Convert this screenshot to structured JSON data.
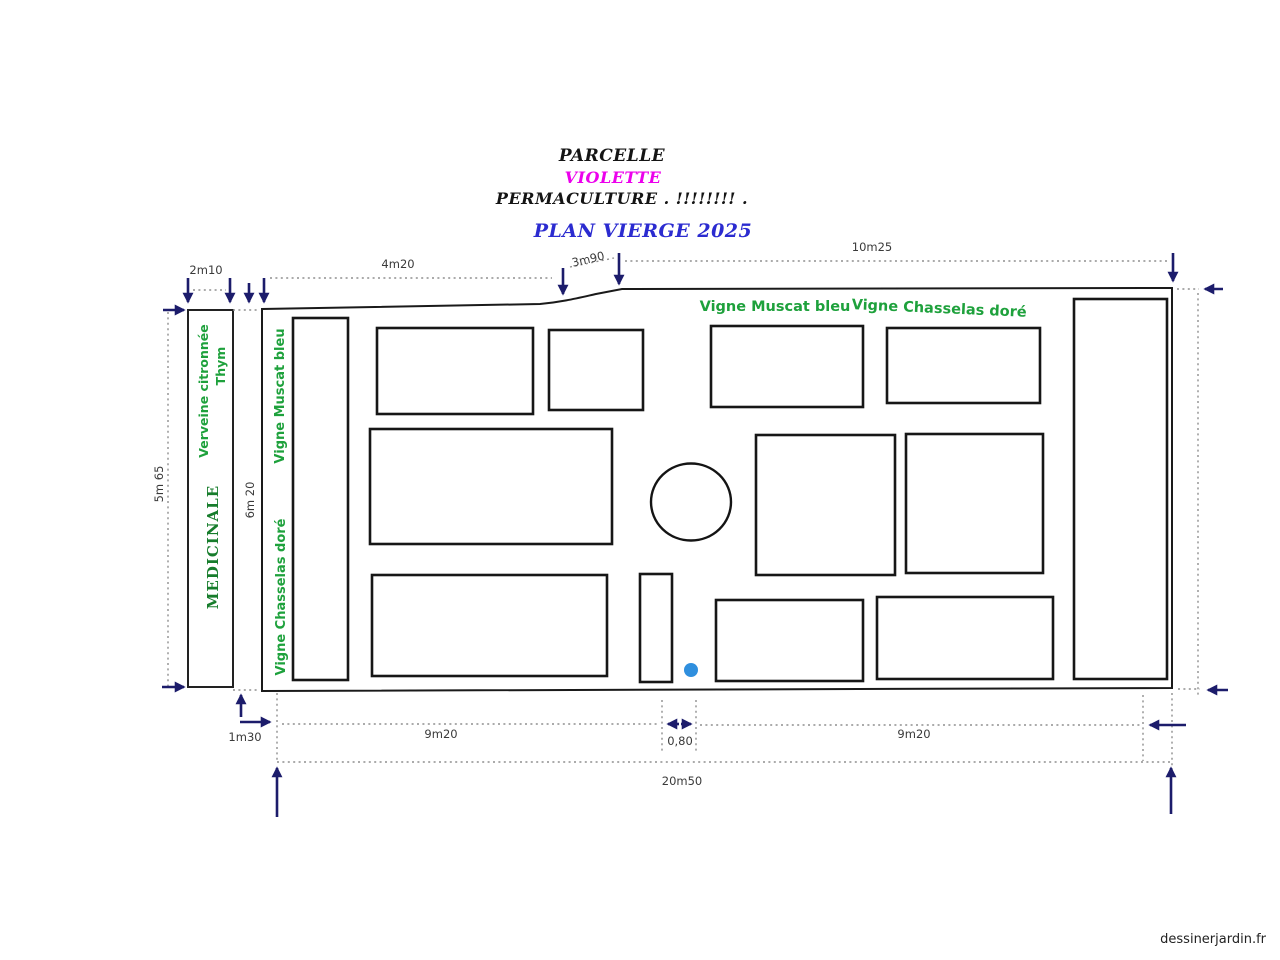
{
  "title": {
    "parcelle": "PARCELLE",
    "violette": "VIOLETTE",
    "permaculture": "PERMACULTURE . !!!!!!!! .",
    "plan_vierge": "PLAN VIERGE 2025"
  },
  "plant_labels": {
    "verveine": "Verveine citronnée",
    "thym": "Thym",
    "medicinale": "MEDICINALE",
    "vigne_muscat_vertical": "Vigne Muscat bleu",
    "vigne_chasselas_vertical": "Vigne Chasselas doré",
    "vigne_muscat_horizontal": "Vigne Muscat bleu",
    "vigne_chasselas_horizontal": "Vigne Chasselas doré"
  },
  "dimensions": {
    "top_strip_width": "2m10",
    "top_left_span": "4m20",
    "top_slope_span": "3m90",
    "top_right_span": "10m25",
    "left_height": "5m 65",
    "inner_height": "6m 20",
    "bottom_offset": "1m30",
    "bottom_left_span": "9m20",
    "bottom_gap": "0,80",
    "bottom_right_span": "9m20",
    "bottom_total": "20m50"
  },
  "colors": {
    "label_green": "#1ea13c",
    "medicinal_green": "#177d2c",
    "title_black": "#141414",
    "title_magenta": "#ec00ec",
    "title_blue": "#2b2bd0",
    "arrow_navy": "#1c1c6b",
    "water_dot_blue": "#2f8fde",
    "dimension_text": "#3a3a3a"
  },
  "watermark": "dessinerjardin.fr"
}
